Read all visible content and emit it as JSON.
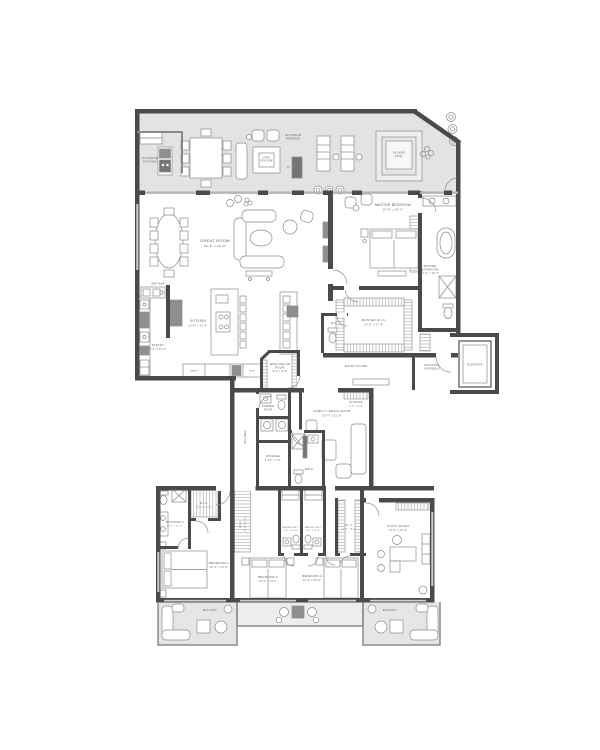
{
  "document": {
    "type": "residential floor plan"
  },
  "colors": {
    "wall": "#4a4a4a",
    "terrace_fill": "#e3e3e3",
    "balcony_fill": "#e6e6e6",
    "furniture_stroke": "#8a8a8a",
    "dark_unit": "#8f8f8f",
    "appliance": "#757575",
    "text": "#5a5a5a"
  },
  "outdoor": {
    "outdoor_kitchen": {
      "label_lines": [
        "OUTDOOR",
        "KITCHEN"
      ]
    },
    "outdoor_terrace": {
      "label_lines": [
        "OUTDOOR",
        "TERRACE"
      ]
    },
    "fire_feature": {
      "label_lines": [
        "FIRE",
        "FEATURE"
      ]
    },
    "tv": {
      "label": "TV"
    },
    "plunge_pool": {
      "label_lines": [
        "PLUNGE",
        "POOL"
      ]
    },
    "balcony_left": {
      "label": "BALCONY"
    },
    "balcony_right": {
      "label": "BALCONY"
    }
  },
  "rooms": {
    "great_room": {
      "label": "GREAT ROOM",
      "dims": "30'-4\" x 24'-0\""
    },
    "master_bedroom": {
      "label": "MASTER BEDROOM",
      "dims": "16'-8\" x 20'-4\""
    },
    "master_bathroom": {
      "label_lines": [
        "MASTER",
        "BATHROOM"
      ],
      "dims": "10'-0\" x 18'-4\""
    },
    "master_wic": {
      "label": "MASTER W.I.C.",
      "dims": "10'-6\" x 17'-8\""
    },
    "wc": {
      "label": "W.C."
    },
    "wet_bar": {
      "label": "WET BAR"
    },
    "pantry": {
      "label": "PANTRY",
      "dims": "5'-4\" x 13'-6\""
    },
    "kitchen": {
      "label": "KITCHEN",
      "dims": "11'-8\" x 21'-4\""
    },
    "entry_foyer": {
      "label": "ENTRY FOYER"
    },
    "elevator_vestibule": {
      "label_lines": [
        "ELEVATOR",
        "VESTIBULE"
      ]
    },
    "elevator": {
      "label": "ELEVATOR"
    },
    "wine_cellar": {
      "label_lines": [
        "WINE CELLAR",
        "ROOM"
      ],
      "dims": "8'-0\" x 9'-6\""
    },
    "powder_room": {
      "label_lines": [
        "POWDER",
        "ROOM"
      ]
    },
    "family_media_room": {
      "label": "FAMILY / MEDIA ROOM",
      "dims": "13'-6\" x 21'-8\""
    },
    "storage_foyer": {
      "label": "STORAGE",
      "dims": "4'-0\" x 8'-2\""
    },
    "hallway": {
      "label": "HALLWAY"
    },
    "storage_hall": {
      "label": "STORAGE",
      "dims": "6'-10\" x 7'-8\""
    },
    "bath": {
      "label": "BATH"
    },
    "bathroom_4": {
      "label": "BATHROOM 4",
      "dims": "6'-8\" x 11'-0\""
    },
    "wic_4": {
      "label": "W.I.C.",
      "dims": "5'-4\" x 6'-8\""
    },
    "wic_3": {
      "label": "W.I.C.",
      "dims": "5'-0\" x 9'-8\""
    },
    "bedroom_4": {
      "label": "BEDROOM 4",
      "dims": "12'-2\" x 13'-8\""
    },
    "bedroom_3": {
      "label": "BEDROOM 3",
      "dims": "12'-4\" x 13'-0\""
    },
    "bathroom_3": {
      "label": "BATHROOM 3",
      "dims": "5'-0\" x 10'-8\""
    },
    "bathroom_2": {
      "label": "BATHROOM 2",
      "dims": "5'-0\" x 10'-8\""
    },
    "wic_2": {
      "label": "W.I.C.",
      "dims": "6'-8\" x 8'-2\""
    },
    "bedroom_2": {
      "label": "BEDROOM 2",
      "dims": "12'-4\" x 13'-0\""
    },
    "study_room": {
      "label": "STUDY ROOM",
      "dims": "13'-0\" x 13'-4\""
    }
  },
  "appliances": {
    "wash": "WASH",
    "ref": "REF"
  }
}
